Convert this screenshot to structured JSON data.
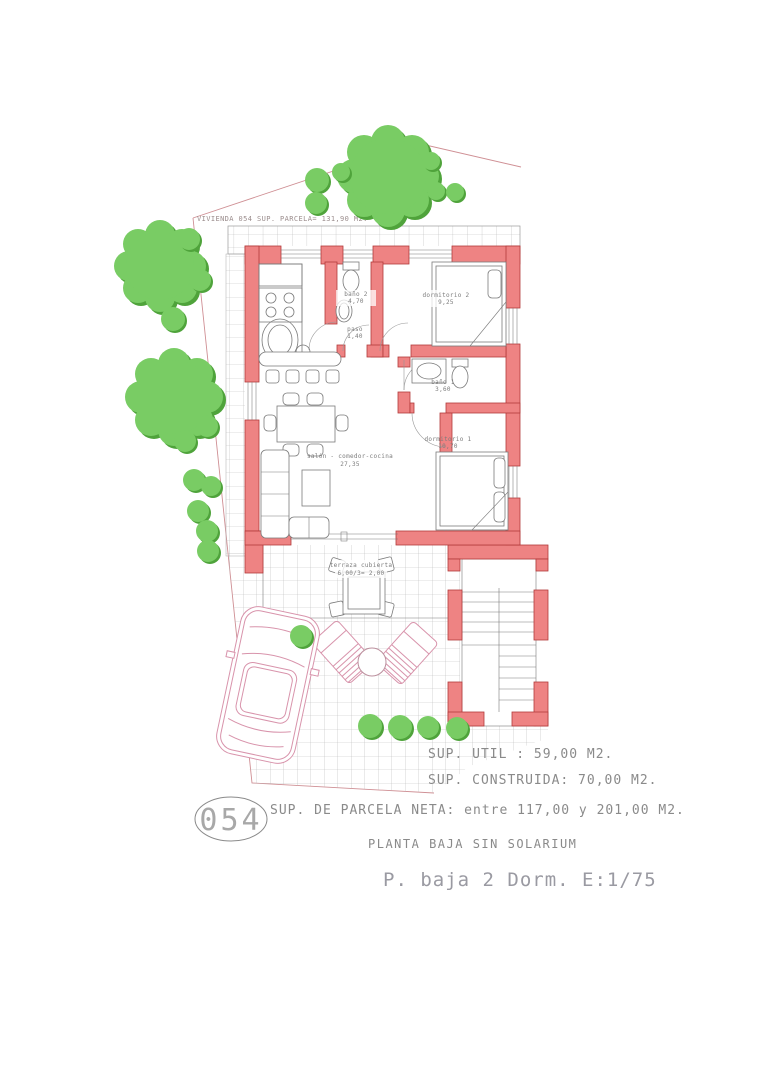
{
  "colors": {
    "wallFill": "#ee8383",
    "wallStroke": "#b23a3a",
    "treeLight": "#79cc64",
    "treeDark": "#4fa33b",
    "boundary": "#cf8f94",
    "car": "#d893ab",
    "gridLine": "#b9b9b9",
    "drawLine": "#7a7a7a",
    "textGray": "#8a8a8a",
    "titleGray": "#9a9aa2"
  },
  "plan": {
    "parcel_note": "VIVIENDA 054 SUP. PARCELA= 131,90 M2.",
    "rooms": [
      {
        "name": "baño 2",
        "area": "4,70"
      },
      {
        "name": "dormitorio 2",
        "area": "9,25"
      },
      {
        "name": "paso",
        "area": "1,40"
      },
      {
        "name": "baño 1",
        "area": "3,60"
      },
      {
        "name": "dormitorio 1",
        "area": "10,70"
      },
      {
        "name": "salón - comedor-cocina",
        "area": "27,35"
      },
      {
        "name": "terraza cubierta",
        "area": "6,00/3= 2,00"
      }
    ]
  },
  "summary": {
    "lines": [
      "SUP. UTIL : 59,00 M2.",
      "SUP. CONSTRUIDA: 70,00 M2.",
      "SUP. DE PARCELA NETA: entre 117,00 y 201,00 M2.",
      "PLANTA BAJA SIN SOLARIUM"
    ],
    "plan_number": "054",
    "drawing_title": "P. baja 2 Dorm. E:1/75"
  }
}
